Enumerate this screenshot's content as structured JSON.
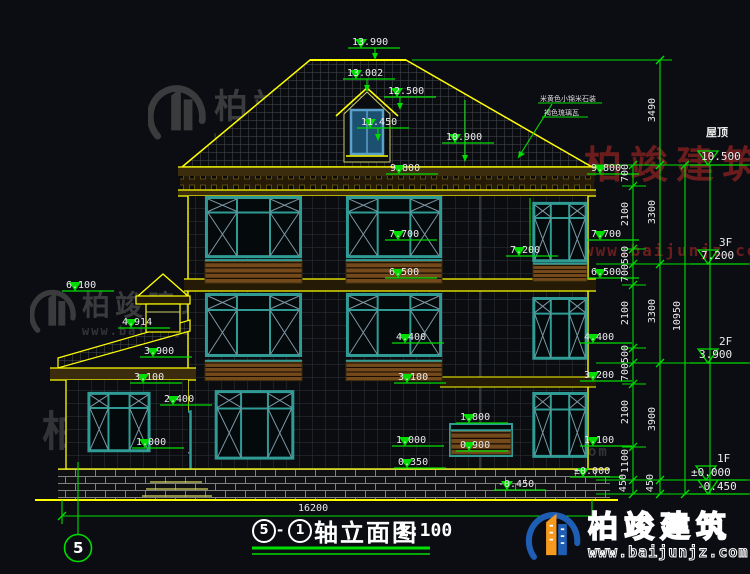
{
  "drawing": {
    "title": {
      "axis_left": "5",
      "axis_right": "1",
      "name": "轴立面图",
      "scale": "1:100"
    },
    "axis_bubble": "5",
    "roof_note": {
      "line1": "米黄色小锦米石装",
      "line2": "褐色琉璃瓦"
    },
    "levels": [
      {
        "v": "13.990"
      },
      {
        "v": "13.002"
      },
      {
        "v": "12.500"
      },
      {
        "v": "11.450"
      },
      {
        "v": "10.900"
      },
      {
        "v": "9.800"
      },
      {
        "v": "9.800"
      },
      {
        "v": "7.700"
      },
      {
        "v": "7.700"
      },
      {
        "v": "7.200"
      },
      {
        "v": "6.500"
      },
      {
        "v": "6.500"
      },
      {
        "v": "6.100"
      },
      {
        "v": "4.914"
      },
      {
        "v": "4.400"
      },
      {
        "v": "4.400"
      },
      {
        "v": "3.900"
      },
      {
        "v": "3.200"
      },
      {
        "v": "3.100"
      },
      {
        "v": "3.100"
      },
      {
        "v": "2.400"
      },
      {
        "v": "1.800"
      },
      {
        "v": "1.100"
      },
      {
        "v": "1.000"
      },
      {
        "v": "1.000"
      },
      {
        "v": "0.900"
      },
      {
        "v": "0.350"
      },
      {
        "v": "±0.000"
      },
      {
        "v": "-0.450"
      }
    ],
    "floor_marks": {
      "roof_label": "屋顶",
      "roof_level": "10.500",
      "f3_label": "3F",
      "f3_level": "7.200",
      "f2_label": "2F",
      "f2_level": "3.900",
      "f1_label": "1F",
      "f1_level": "±0.000",
      "below_level": "-0.450"
    },
    "dim_chain_inner": [
      "700",
      "2100",
      "500",
      "700",
      "2100",
      "500",
      "700",
      "2100",
      "1100",
      "450"
    ],
    "dim_chain_mid": [
      "3490",
      "3300",
      "3300",
      "3900",
      "450"
    ],
    "dim_chain_outer": [
      "10950"
    ],
    "total_width": "16200"
  },
  "watermark": {
    "brand": "柏竣建筑",
    "site": "www.baijunjz.com"
  },
  "colors": {
    "background": "#0b0d13",
    "line_green": "#00dd00",
    "line_yellow": "#ffff00",
    "text_white": "#ececec",
    "window_teal": "#2f9b95",
    "railing_brown": "#744a1c",
    "band_brown": "#3a2c0c",
    "watermark_gray": "#5a5a5a",
    "watermark_red": "#7c2020",
    "logo_blue": "#1e5fb5",
    "logo_orange": "#f59a1e"
  }
}
